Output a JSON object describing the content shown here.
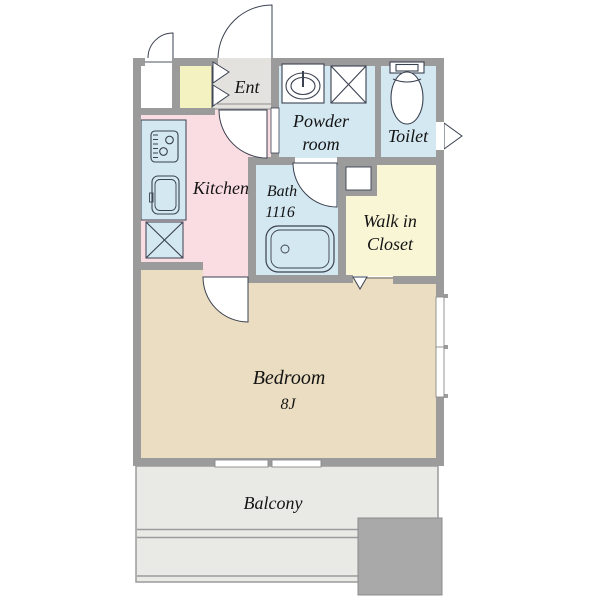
{
  "rooms": {
    "entrance": {
      "label": "Ent"
    },
    "powder_room": {
      "label_lines": [
        "Powder",
        "room"
      ]
    },
    "toilet": {
      "label": "Toilet"
    },
    "kitchen": {
      "label": "Kitchen"
    },
    "bath": {
      "label_lines": [
        "Bath",
        "1116"
      ]
    },
    "walk_in_closet": {
      "label_lines": [
        "Walk in",
        "Closet"
      ]
    },
    "bedroom": {
      "label_lines": [
        "Bedroom",
        "8J"
      ]
    },
    "balcony": {
      "label": "Balcony"
    }
  },
  "colors": {
    "wall": "#9b9b9b",
    "line": "#3a4150",
    "entry_floor": "#e4e2de",
    "closet_yellow": "#f5f2c1",
    "wic_yellow": "#f9f6d6",
    "wet_blue": "#d4e8f2",
    "kitchen_pink": "#fadde2",
    "bedroom_tan": "#ebddc1",
    "balcony_gray": "#e9e9e6",
    "block_gray": "#a9a9a9",
    "text": "#141414"
  }
}
